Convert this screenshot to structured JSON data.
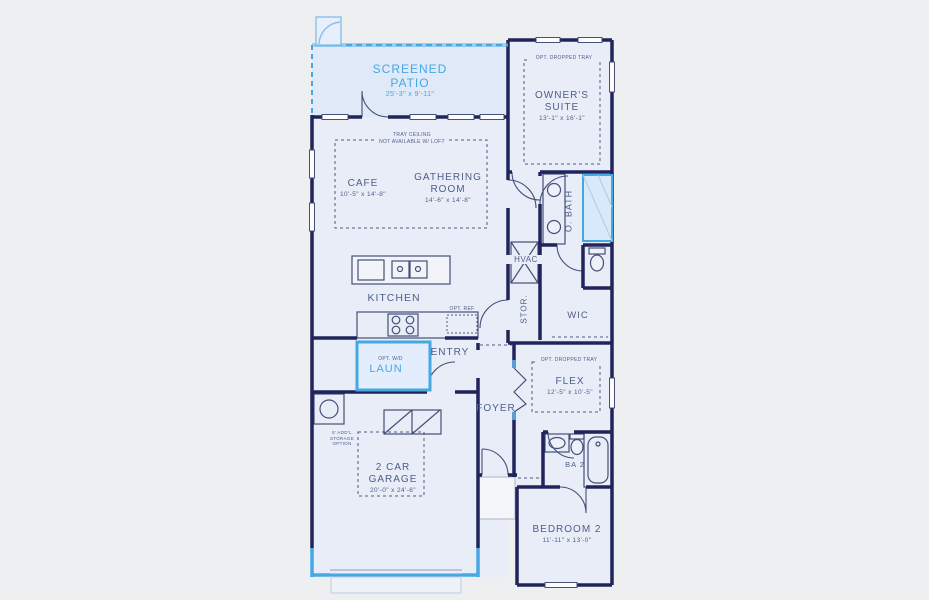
{
  "title": "Floor Plan",
  "colors": {
    "accent_blue": "#46a8e3",
    "wall_navy": "#20245a",
    "label_navy": "#4e5e8a",
    "interior_fill": "#e9edf8",
    "background": "#eeeff1"
  },
  "rooms": {
    "screened_patio": {
      "name": "SCREENED PATIO",
      "dims": "25'-3\" x 9'-11\""
    },
    "owners_suite": {
      "name": "OWNER'S SUITE",
      "dims": "13'-1\" x 16'-1\""
    },
    "cafe": {
      "name": "CAFE",
      "dims": "10'-5\" x 14'-8\""
    },
    "gathering_room": {
      "name": "GATHERING ROOM",
      "dims": "14'-6\" x 14'-8\""
    },
    "kitchen": {
      "name": "KITCHEN"
    },
    "o_bath": {
      "name": "O. BATH"
    },
    "hvac": {
      "name": "HVAC"
    },
    "stor": {
      "name": "STOR."
    },
    "wic": {
      "name": "WIC"
    },
    "laun": {
      "name": "LAUN"
    },
    "entry": {
      "name": "ENTRY"
    },
    "foyer": {
      "name": "FOYER"
    },
    "flex": {
      "name": "FLEX",
      "dims": "12'-5\" x 10'-5\""
    },
    "ba2": {
      "name": "BA 2"
    },
    "bedroom2": {
      "name": "BEDROOM 2",
      "dims": "11'-11\" x 13'-0\""
    },
    "garage": {
      "name": "2 CAR GARAGE",
      "dims": "20'-0\" x 24'-6\""
    }
  },
  "annotations": {
    "tray_ceiling_line1": "TRAY CEILING",
    "tray_ceiling_line2": "NOT AVAILABLE W/ LOFT",
    "opt_dropped_tray_owner": "OPT. DROPPED TRAY",
    "opt_dropped_tray_flex": "OPT. DROPPED TRAY",
    "opt_ref": "OPT. REF",
    "opt_wd": "OPT. W/D",
    "storage_option": "5' ADD'L STORAGE OPTION"
  }
}
